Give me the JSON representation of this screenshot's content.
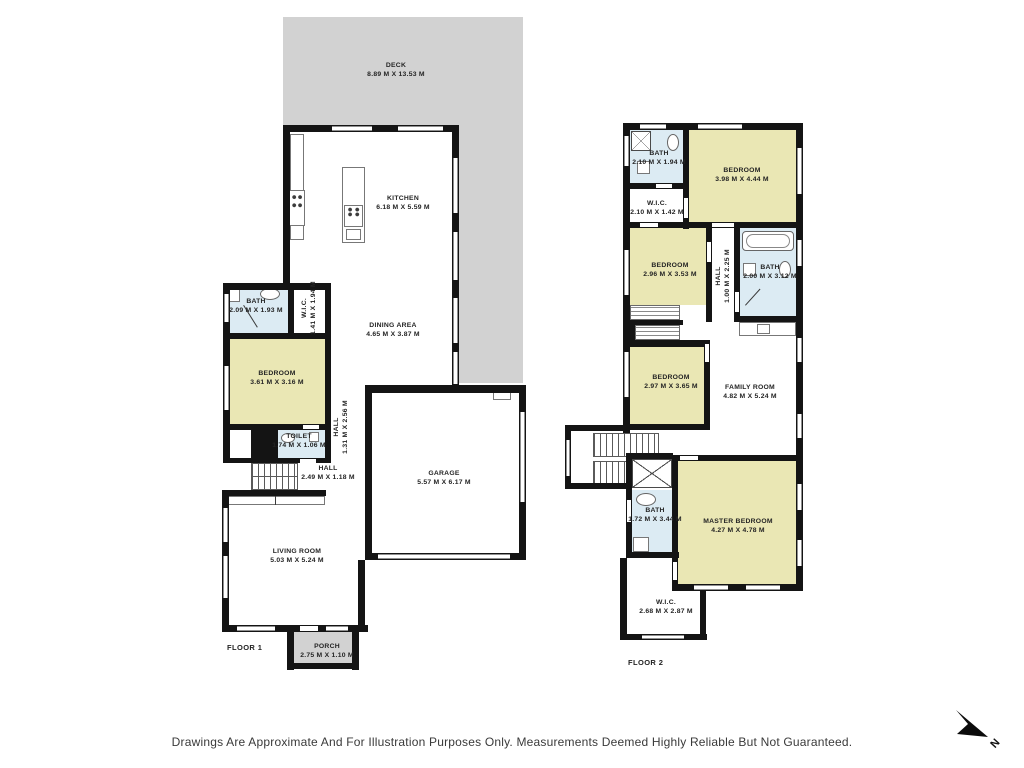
{
  "colors": {
    "wall": "#141414",
    "bedroom_fill": "#eae7b4",
    "bath_fill": "#dcebf3",
    "deck_fill": "#d2d2d2",
    "label_text": "#242424"
  },
  "floor1": {
    "label": "FLOOR 1",
    "deck": {
      "name": "DECK",
      "dims": "8.89 M X 13.53 M"
    },
    "kitchen": {
      "name": "KITCHEN",
      "dims": "6.18 M X 5.59 M"
    },
    "dining": {
      "name": "DINING AREA",
      "dims": "4.65 M X 3.87 M"
    },
    "bath": {
      "name": "BATH",
      "dims": "2.09 M X 1.93 M"
    },
    "wic": {
      "name": "W.I.C.",
      "dims": "1.41 M X 1.94 M"
    },
    "bedroom": {
      "name": "BEDROOM",
      "dims": "3.61 M X 3.16 M"
    },
    "toilet": {
      "name": "TOILET",
      "dims": "1.74 M X 1.06 M"
    },
    "hall_upper": {
      "name": "HALL",
      "dims": "1.31 M X 2.56 M"
    },
    "hall": {
      "name": "HALL",
      "dims": "2.49 M X 1.18 M"
    },
    "garage": {
      "name": "GARAGE",
      "dims": "5.57 M X 6.17 M"
    },
    "living": {
      "name": "LIVING ROOM",
      "dims": "5.03 M X 5.24 M"
    },
    "porch": {
      "name": "PORCH",
      "dims": "2.75 M X 1.10 M"
    }
  },
  "floor2": {
    "label": "FLOOR 2",
    "bath_top": {
      "name": "BATH",
      "dims": "2.10 M X 1.94 M"
    },
    "bedroom_top": {
      "name": "BEDROOM",
      "dims": "3.98 M X 4.44 M"
    },
    "wic_top": {
      "name": "W.I.C.",
      "dims": "2.10 M X 1.42 M"
    },
    "bedroom_mid": {
      "name": "BEDROOM",
      "dims": "2.96 M X 3.53 M"
    },
    "hall": {
      "name": "HALL",
      "dims": "1.00 M X 2.25 M"
    },
    "bath_mid": {
      "name": "BATH",
      "dims": "2.00 M X 3.12 M"
    },
    "bedroom_lower": {
      "name": "BEDROOM",
      "dims": "2.97 M X 3.65 M"
    },
    "family": {
      "name": "FAMILY ROOM",
      "dims": "4.82 M X 5.24 M"
    },
    "bath_lower": {
      "name": "BATH",
      "dims": "1.72 M X 3.44 M"
    },
    "master": {
      "name": "MASTER BEDROOM",
      "dims": "4.27 M  X  4.78 M"
    },
    "wic_lower": {
      "name": "W.I.C.",
      "dims": "2.68 M X 2.87 M"
    }
  },
  "compass": {
    "label": "N"
  },
  "footer": {
    "disclaimer": "Drawings Are Approximate And For Illustration Purposes Only. Measurements Deemed Highly Reliable But Not Guaranteed."
  }
}
